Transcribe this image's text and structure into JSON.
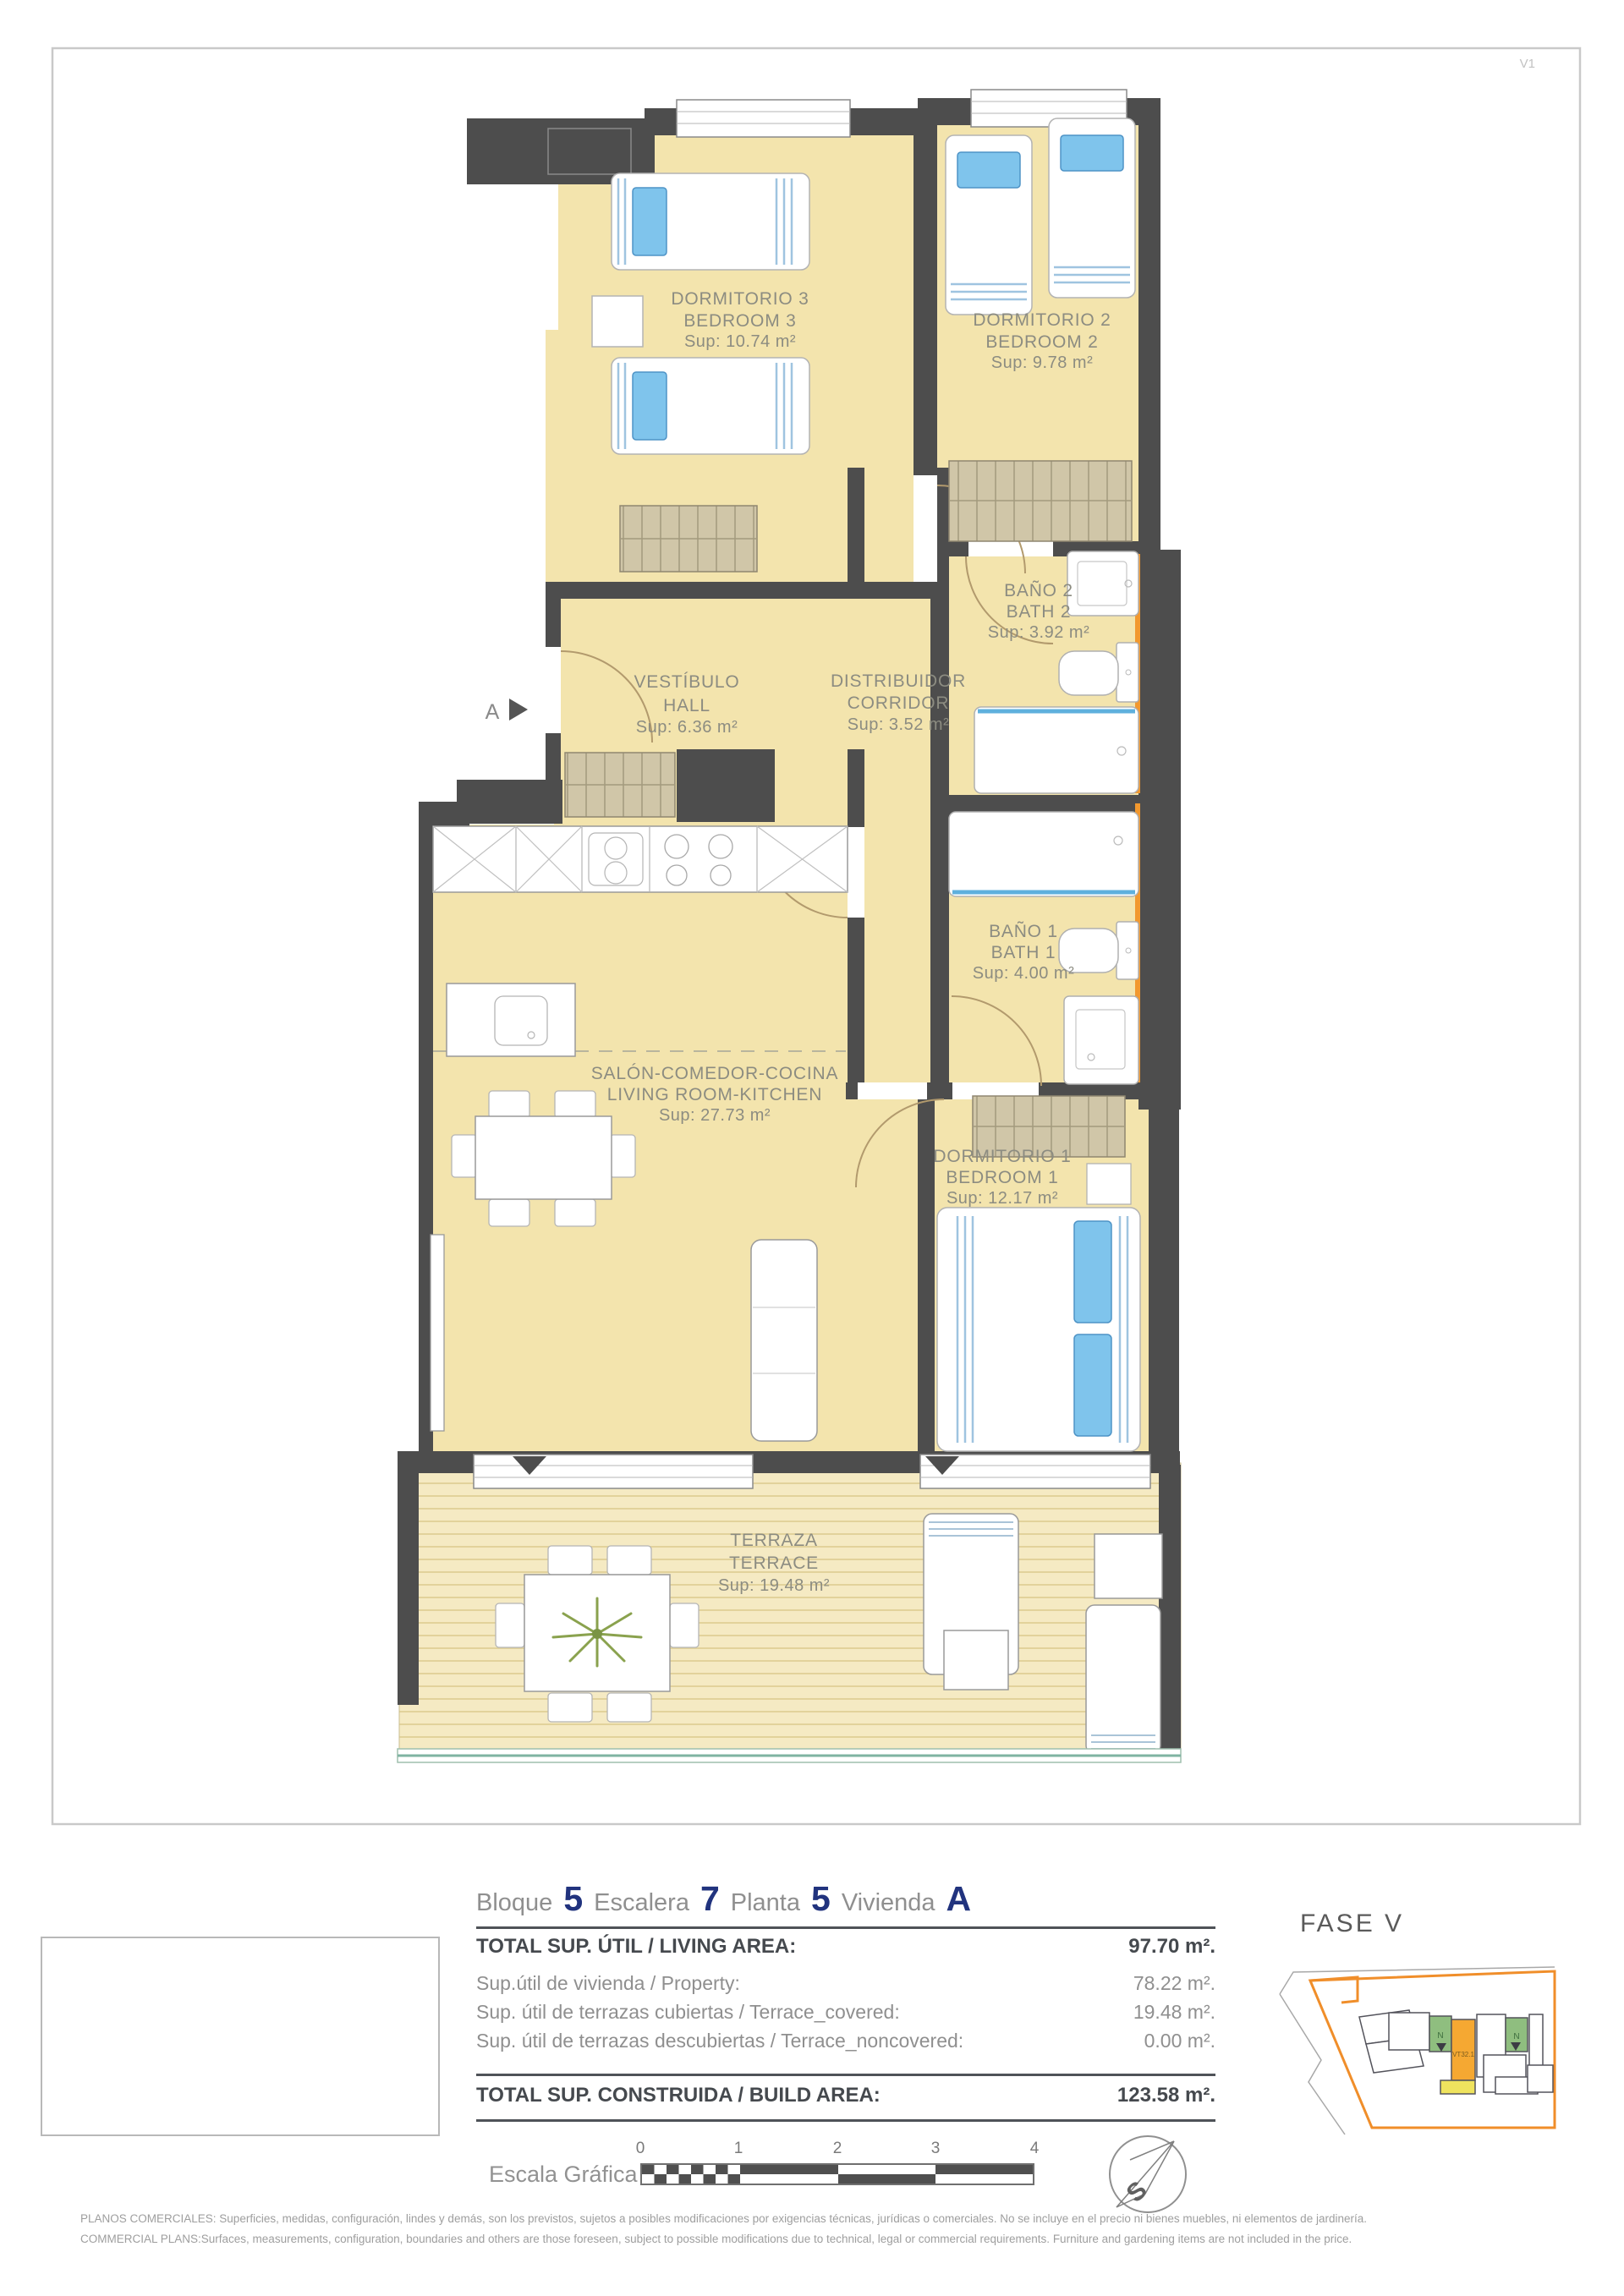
{
  "sheet": {
    "code": "V1"
  },
  "plan": {
    "entrance_label": "A",
    "rooms": [
      {
        "id": "bedroom3",
        "es": "DORMITORIO 3",
        "en": "BEDROOM 3",
        "area": "Sup: 10.74 m²"
      },
      {
        "id": "bedroom2",
        "es": "DORMITORIO 2",
        "en": "BEDROOM 2",
        "area": "Sup: 9.78 m²"
      },
      {
        "id": "bath2",
        "es": "BAÑO 2",
        "en": "BATH 2",
        "area": "Sup: 3.92 m²"
      },
      {
        "id": "hall",
        "es": "VESTÍBULO",
        "en": "HALL",
        "area": "Sup: 6.36 m²"
      },
      {
        "id": "corridor",
        "es": "DISTRIBUIDOR",
        "en": "CORRIDOR",
        "area": "Sup: 3.52 m²"
      },
      {
        "id": "bath1",
        "es": "BAÑO 1",
        "en": "BATH 1",
        "area": "Sup: 4.00 m²"
      },
      {
        "id": "living",
        "es": "SALÓN-COMEDOR-COCINA",
        "en": "LIVING ROOM-KITCHEN",
        "area": "Sup: 27.73 m²"
      },
      {
        "id": "bedroom1",
        "es": "DORMITORIO 1",
        "en": "BEDROOM 1",
        "area": "Sup: 12.17 m²"
      },
      {
        "id": "terrace",
        "es": "TERRAZA",
        "en": "TERRACE",
        "area": "Sup: 19.48 m²"
      }
    ]
  },
  "header": {
    "bloque_label": "Bloque",
    "bloque": "5",
    "escalera_label": "Escalera",
    "escalera": "7",
    "planta_label": "Planta",
    "planta": "5",
    "vivienda_label": "Vivienda",
    "vivienda": "A"
  },
  "areas": {
    "total_living_label": "TOTAL SUP. ÚTIL / LIVING AREA:",
    "total_living_value": "97.70 m².",
    "rows": [
      {
        "label": "Sup.útil de vivienda / Property:",
        "value": "78.22 m²."
      },
      {
        "label": "Sup. útil de terrazas cubiertas  / Terrace_covered:",
        "value": "19.48 m²."
      },
      {
        "label": "Sup. útil de terrazas descubiertas  / Terrace_noncovered:",
        "value": "0.00 m²."
      }
    ],
    "total_build_label": "TOTAL SUP. CONSTRUIDA / BUILD AREA:",
    "total_build_value": "123.58 m²."
  },
  "scale": {
    "label": "Escala Gráfica",
    "ticks": [
      "0",
      "1",
      "2",
      "3",
      "4"
    ]
  },
  "compass": {
    "letter": "S"
  },
  "keyplan": {
    "phase": "FASE V",
    "unit": "VT32.1",
    "north1": "N",
    "north2": "N"
  },
  "colors": {
    "wall": "#4d4d4d",
    "floor": "#f3e4ad",
    "accent_orange": "#f2982e",
    "highlight_orange": "#f5a832",
    "highlight_yellow": "#efe35e",
    "highlight_green": "#8fbe7f",
    "number_blue": "#21337e"
  },
  "disclaimer": {
    "line1": "PLANOS COMERCIALES: Superficies, medidas, configuración, lindes y demás, son los previstos, sujetos a posibles modificaciones por exigencias técnicas, jurídicas o comerciales. No se incluye en el precio ni bienes muebles, ni elementos de jardinería.",
    "line2": "COMMERCIAL PLANS:Surfaces, measurements, configuration, boundaries and others are those foreseen, subject to possible modifications due to technical, legal or commercial requirements. Furniture and gardening items are not included in the price."
  }
}
